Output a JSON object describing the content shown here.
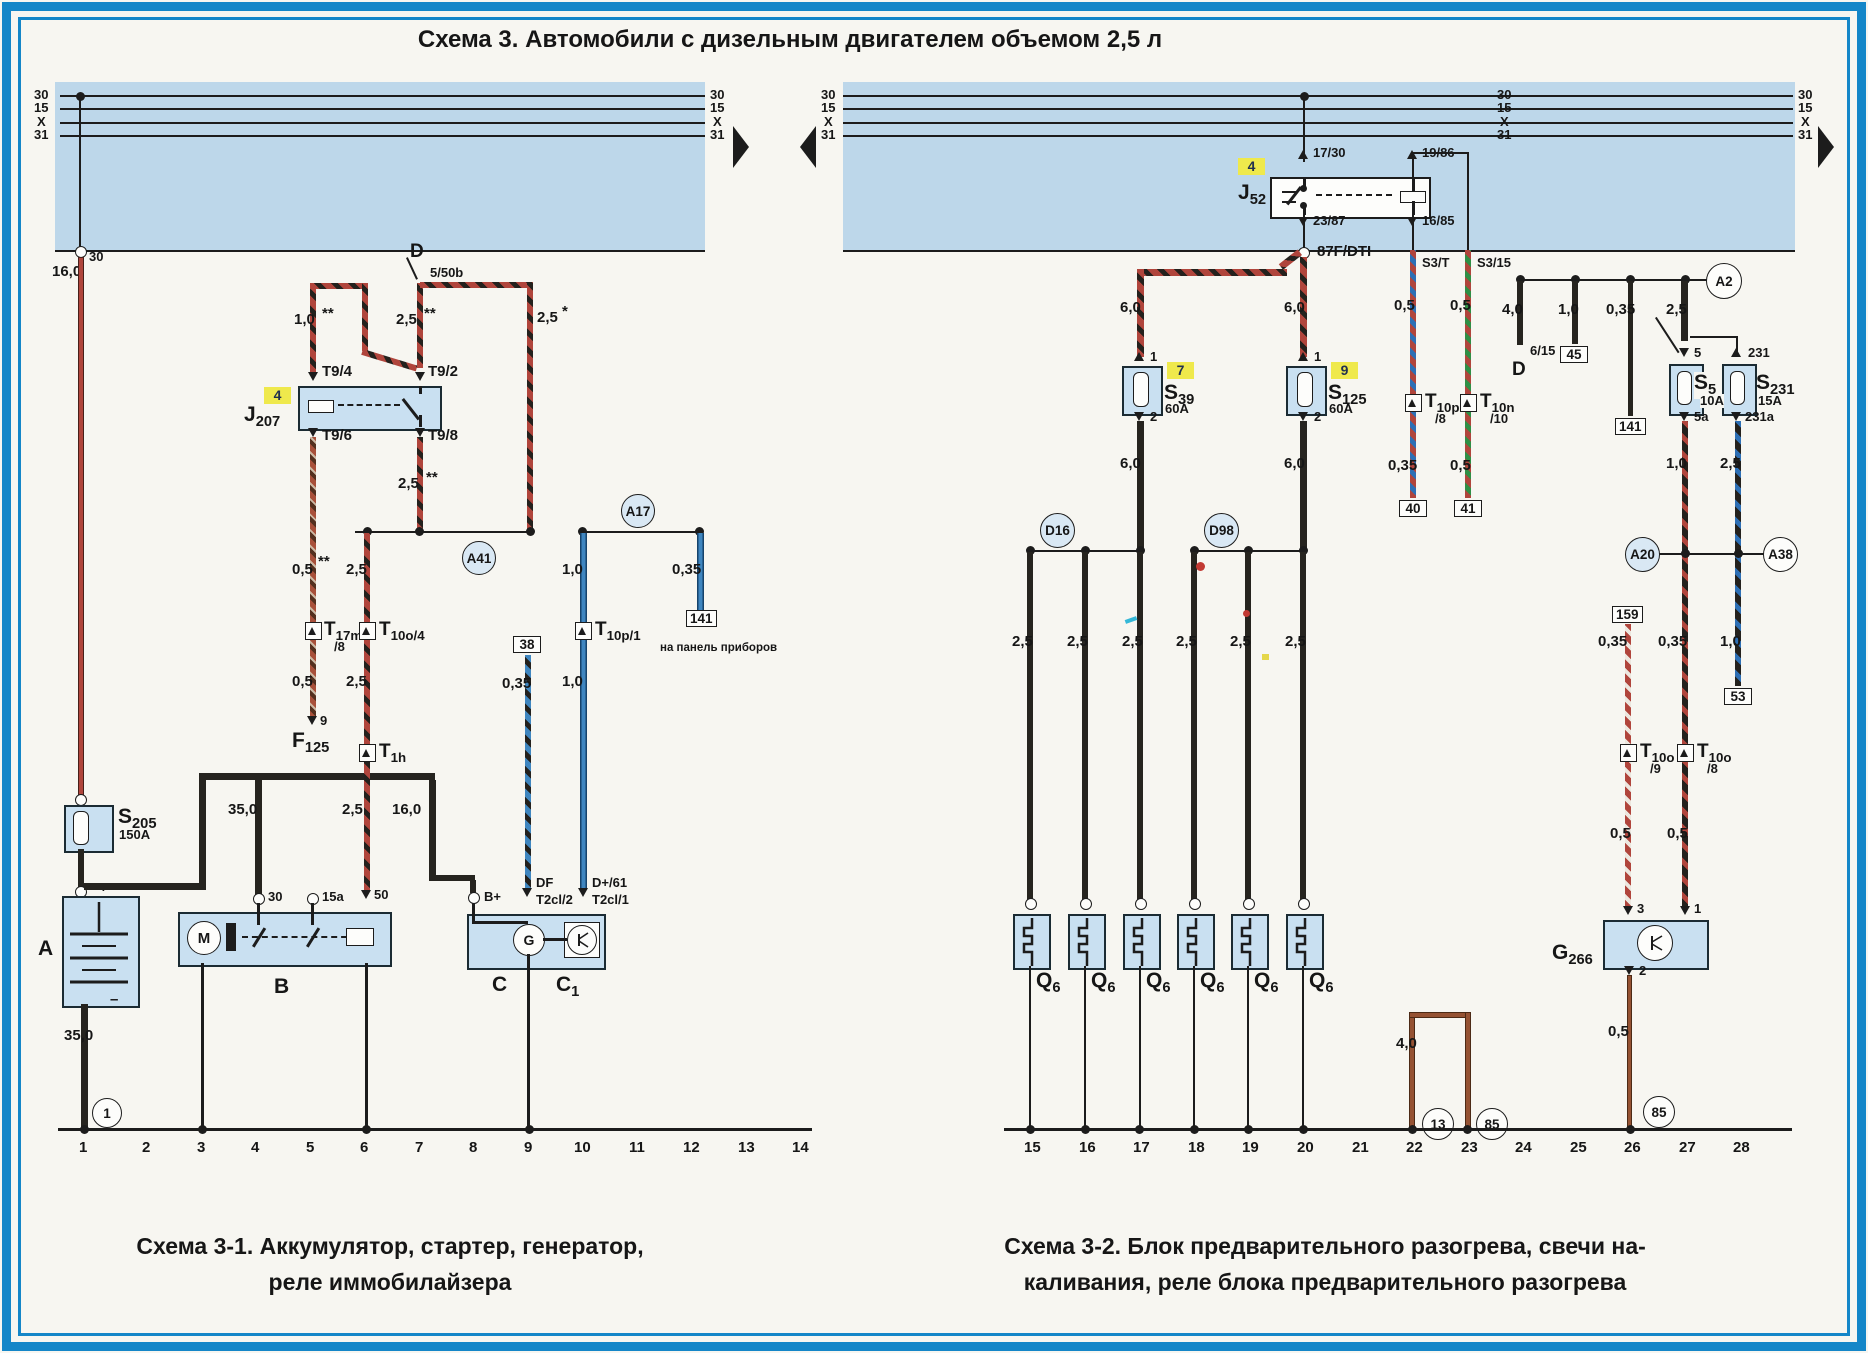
{
  "colors": {
    "frame": "#1486c8",
    "band": "#bdd7ea",
    "box": "#c9e0f1",
    "highlight": "#efe94c",
    "wire_red": "#b0453c",
    "wire_blue": "#3f86c0",
    "wire_brown": "#955233",
    "wire_black": "#26241f"
  },
  "page": {
    "title": "Схема 3. Автомобили с дизельным двигателем объемом 2,5 л",
    "caption_left_1": "Схема 3-1. Аккумулятор, стартер, генератор,",
    "caption_left_2": "реле иммобилайзера",
    "caption_right_1": "Схема 3-2. Блок предварительного разогрева, свечи на-",
    "caption_right_2": "каливания, реле блока предварительного разогрева"
  },
  "bus": {
    "t30": "30",
    "t15": "15",
    "tx": "X",
    "t31": "31"
  },
  "w": {
    "s05": "0,5",
    "s035": "0,35",
    "s10": "1,0",
    "s25": "2,5",
    "s40": "4,0",
    "s60": "6,0",
    "s160": "16,0",
    "s350": "35,0",
    "star": "*",
    "star2": "**"
  },
  "left": {
    "term30": "30",
    "d": "D",
    "d_term": "5/50b",
    "tag": "4",
    "j": "J",
    "j_sub": "207",
    "t94": "T9/4",
    "t92": "T9/2",
    "t96": "T9/6",
    "t98": "T9/8",
    "a41": "A41",
    "a17": "A17",
    "t17m": "T",
    "t17m_sub": "17m",
    "t17m_pin": "/8",
    "pin9": "9",
    "f": "F",
    "f_sub": "125",
    "t10o4": "T",
    "t10o4_sub": "10o/4",
    "t1h": "T",
    "t1h_sub": "1h",
    "t10p1": "T",
    "t10p1_sub": "10p/1",
    "box38": "38",
    "box141": "141",
    "panel_note": "на панель приборов",
    "s205": "S",
    "s205_sub": "205",
    "s205_amp": "150A",
    "bat": "A",
    "plus": "+",
    "minus": "–",
    "b": "B",
    "b30": "30",
    "b15a": "15a",
    "b50": "50",
    "m": "M",
    "c": "C",
    "c1": "C",
    "c1_sub": "1",
    "g": "G",
    "bplus": "B+",
    "df": "DF",
    "df_pin": "T2cl/2",
    "dplus": "D+/61",
    "dplus_pin": "T2cl/1",
    "gnd1": "1",
    "ground": [
      "1",
      "2",
      "3",
      "4",
      "5",
      "6",
      "7",
      "8",
      "9",
      "10",
      "11",
      "12",
      "13",
      "14"
    ]
  },
  "right": {
    "tag": "4",
    "j": "J",
    "j_sub": "52",
    "t1730": "17/30",
    "t1986": "19/86",
    "t2387": "23/87",
    "t1685": "16/85",
    "node": "87F/DTI",
    "s3t": "S3/T",
    "s315": "S3/15",
    "tag7": "7",
    "tag9": "9",
    "s39": "S",
    "s39_sub": "39",
    "s39_amp": "60A",
    "s125": "S",
    "s125_sub": "125",
    "s125_amp": "60A",
    "pin1": "1",
    "pin2": "2",
    "pin3": "3",
    "d16": "D16",
    "d98": "D98",
    "q": "Q",
    "q_sub": "6",
    "t10p": "T",
    "t10p_sub": "10p",
    "t10p_pin": "/8",
    "t10n": "T",
    "t10n_sub": "10n",
    "t10n_pin": "/10",
    "box40": "40",
    "box41": "41",
    "d": "D",
    "d615": "6/15",
    "box45": "45",
    "box141": "141",
    "a2": "A2",
    "term5": "5",
    "term5a": "5a",
    "term231": "231",
    "term231a": "231a",
    "s5": "S",
    "s5_sub": "5",
    "s5_amp": "10A",
    "s231": "S",
    "s231_sub": "231",
    "s231_amp": "15A",
    "a20": "A20",
    "a38": "A38",
    "box159": "159",
    "box53": "53",
    "t10o9": "T",
    "t10o9_sub": "10o",
    "t10o9_pin": "/9",
    "t10o8": "T",
    "t10o8_sub": "10o",
    "t10o8_pin": "/8",
    "g266": "G",
    "g266_sub": "266",
    "c13": "13",
    "c85": "85",
    "ground": [
      "15",
      "16",
      "17",
      "18",
      "19",
      "20",
      "21",
      "22",
      "23",
      "24",
      "25",
      "26",
      "27",
      "28"
    ]
  }
}
